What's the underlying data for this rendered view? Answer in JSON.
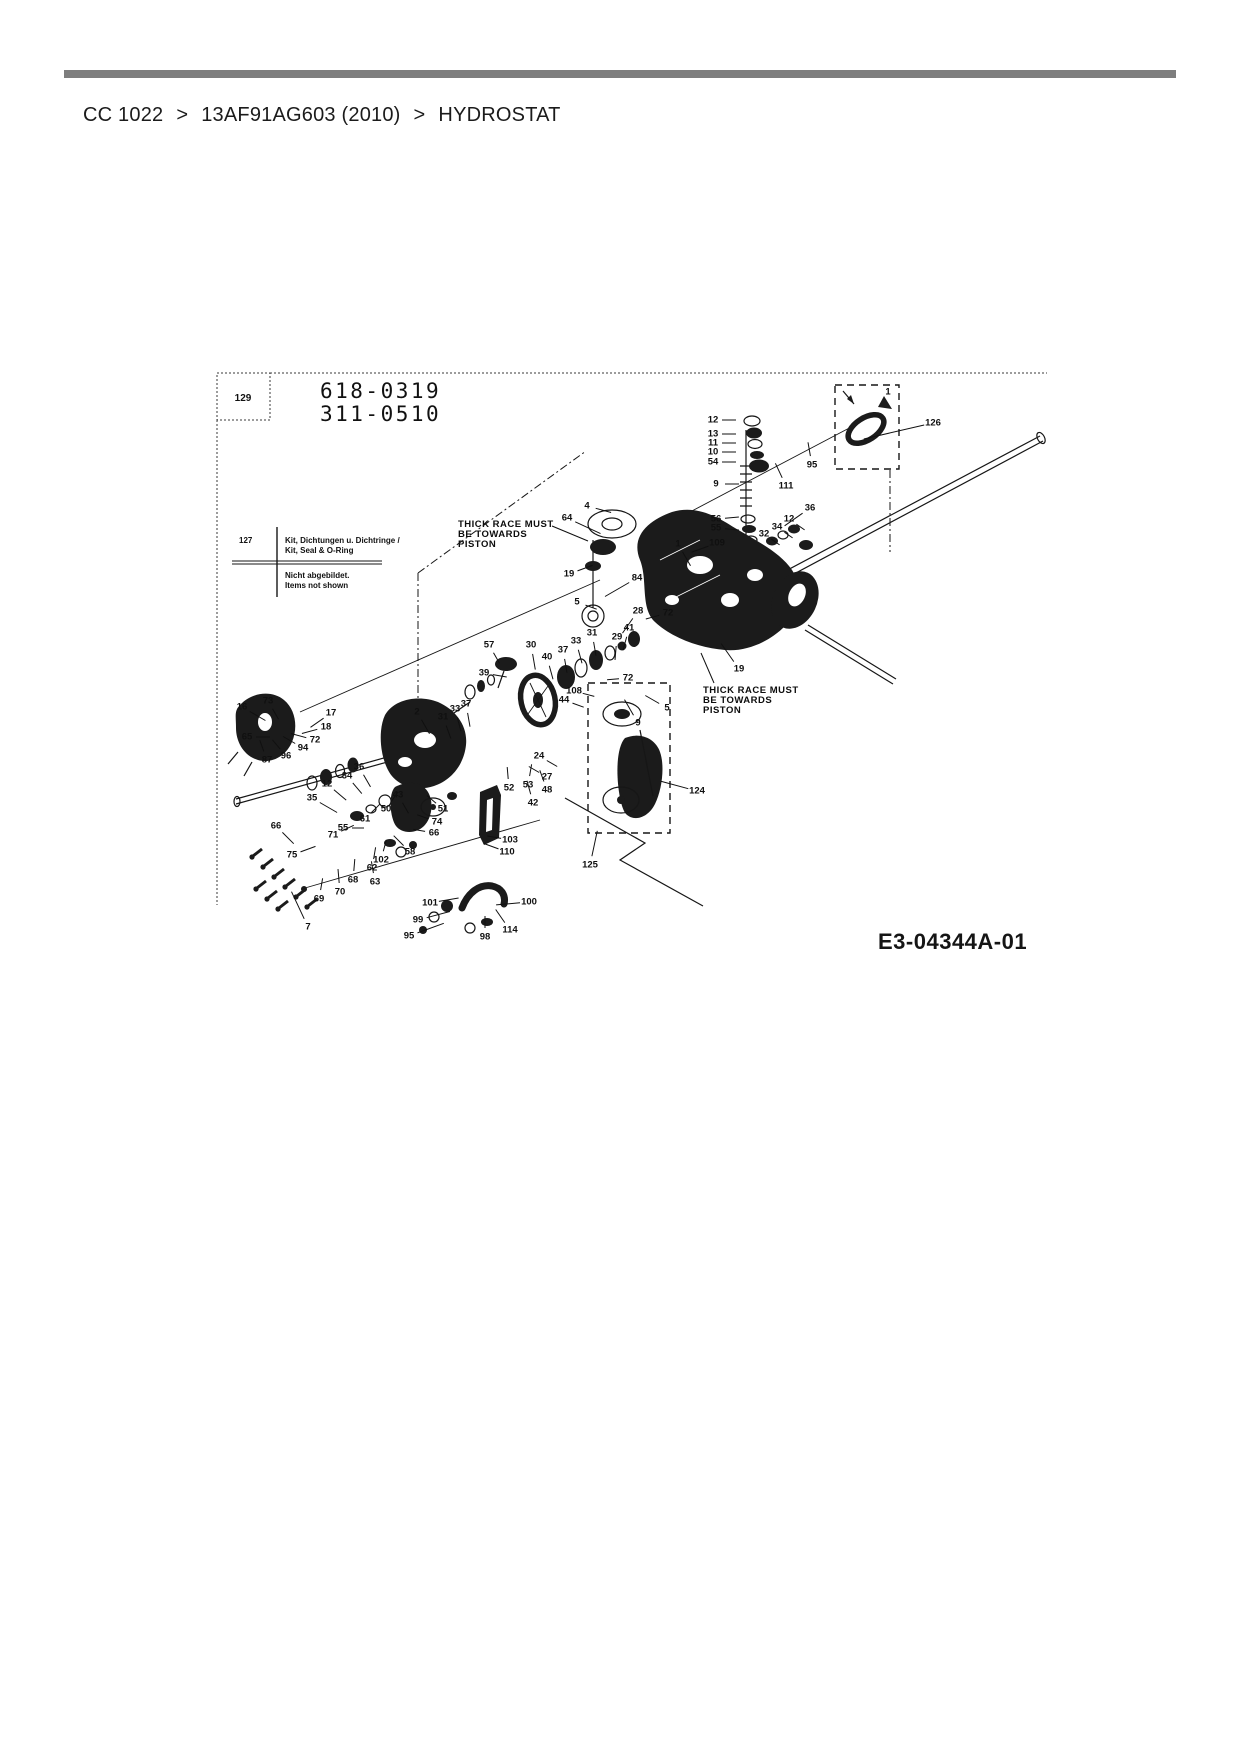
{
  "page": {
    "background": "#ffffff",
    "divider_color": "#7e7e7e"
  },
  "breadcrumb": {
    "separator": ">",
    "items": [
      "CC 1022",
      "13AF91AG603 (2010)",
      "HYDROSTAT"
    ]
  },
  "diagram": {
    "ref_box_label": "129",
    "part_numbers": [
      "618-0319",
      "311-0510"
    ],
    "kit_note": {
      "id": "127",
      "lines": [
        "Kit, Dichtungen u. Dichtringe /",
        "Kit, Seal & O-Ring",
        "Nicht abgebildet.",
        "Items not shown"
      ]
    },
    "annotations": [
      {
        "lines": [
          "THICK RACE MUST",
          "BE TOWARDS",
          "PISTON"
        ]
      },
      {
        "lines": [
          "THICK RACE MUST",
          "BE TOWARDS",
          "PISTON"
        ]
      }
    ],
    "drawing_code": "E3-04344A-01",
    "labels": [
      [
        "12",
        713,
        420,
        0,
        14
      ],
      [
        "13",
        713,
        434,
        0,
        14
      ],
      [
        "11",
        713,
        443,
        0,
        14
      ],
      [
        "10",
        713,
        452,
        0,
        14
      ],
      [
        "54",
        713,
        462,
        0,
        14
      ],
      [
        "9",
        716,
        484,
        0,
        14
      ],
      [
        "56",
        716,
        519,
        5,
        14
      ],
      [
        "55",
        716,
        528,
        355,
        14
      ],
      [
        "95",
        812,
        465,
        100,
        14
      ],
      [
        "111",
        786,
        486,
        115,
        16
      ],
      [
        "126",
        933,
        423,
        193,
        62
      ],
      [
        "1",
        888,
        392,
        0,
        0
      ],
      [
        "36",
        810,
        508,
        215,
        22
      ],
      [
        "12",
        789,
        519,
        325,
        10
      ],
      [
        "34",
        777,
        527,
        325,
        10
      ],
      [
        "32",
        764,
        534,
        325,
        10
      ],
      [
        "109",
        717,
        543,
        200,
        18
      ],
      [
        "1",
        678,
        544,
        300,
        16
      ],
      [
        "64",
        567,
        518,
        335,
        28
      ],
      [
        "4",
        587,
        506,
        345,
        16
      ],
      [
        "19",
        569,
        574,
        20,
        16
      ],
      [
        "5",
        577,
        602,
        340,
        12
      ],
      [
        "84",
        637,
        578,
        210,
        28
      ],
      [
        "28",
        638,
        611,
        235,
        18
      ],
      [
        "72",
        668,
        613,
        195,
        14
      ],
      [
        "57",
        489,
        645,
        300,
        12
      ],
      [
        "39",
        484,
        673,
        350,
        14
      ],
      [
        "30",
        531,
        645,
        280,
        16
      ],
      [
        "40",
        547,
        657,
        285,
        14
      ],
      [
        "37",
        563,
        650,
        280,
        14
      ],
      [
        "33",
        576,
        641,
        285,
        14
      ],
      [
        "31",
        592,
        633,
        280,
        14
      ],
      [
        "29",
        617,
        637,
        265,
        14
      ],
      [
        "41",
        629,
        628,
        255,
        14
      ],
      [
        "72",
        628,
        678,
        185,
        12
      ],
      [
        "108",
        574,
        691,
        345,
        12
      ],
      [
        "44",
        564,
        700,
        340,
        12
      ],
      [
        "5",
        667,
        708,
        150,
        16
      ],
      [
        "9",
        638,
        723,
        120,
        18
      ],
      [
        "19",
        739,
        669,
        125,
        22
      ],
      [
        "24",
        539,
        756,
        330,
        12
      ],
      [
        "27",
        547,
        777,
        150,
        12
      ],
      [
        "52",
        509,
        788,
        95,
        12
      ],
      [
        "53",
        528,
        785,
        80,
        12
      ],
      [
        "48",
        547,
        790,
        110,
        12
      ],
      [
        "42",
        533,
        803,
        105,
        14
      ],
      [
        "124",
        697,
        791,
        165,
        28
      ],
      [
        "125",
        590,
        865,
        78,
        26
      ],
      [
        "103",
        510,
        840,
        170,
        14
      ],
      [
        "110",
        507,
        852,
        160,
        16
      ],
      [
        "16",
        242,
        707,
        330,
        18
      ],
      [
        "73",
        268,
        701,
        300,
        12
      ],
      [
        "17",
        331,
        713,
        215,
        16
      ],
      [
        "18",
        326,
        727,
        195,
        16
      ],
      [
        "72",
        315,
        740,
        165,
        16
      ],
      [
        "94",
        303,
        748,
        150,
        14
      ],
      [
        "96",
        286,
        756,
        130,
        12
      ],
      [
        "87",
        267,
        760,
        110,
        12
      ],
      [
        "65",
        247,
        737,
        0,
        14
      ],
      [
        "2",
        417,
        712,
        300,
        16
      ],
      [
        "31",
        443,
        717,
        290,
        14
      ],
      [
        "33",
        455,
        709,
        285,
        14
      ],
      [
        "37",
        466,
        704,
        280,
        14
      ],
      [
        "36",
        359,
        767,
        300,
        14
      ],
      [
        "34",
        347,
        776,
        310,
        14
      ],
      [
        "12",
        327,
        784,
        320,
        16
      ],
      [
        "35",
        312,
        798,
        330,
        20
      ],
      [
        "66",
        276,
        826,
        315,
        16
      ],
      [
        "71",
        333,
        835,
        25,
        14
      ],
      [
        "75",
        292,
        855,
        20,
        16
      ],
      [
        "55",
        343,
        828,
        0,
        12
      ],
      [
        "61",
        365,
        819,
        45,
        12
      ],
      [
        "50",
        386,
        809,
        55,
        12
      ],
      [
        "43",
        398,
        795,
        300,
        12
      ],
      [
        "51",
        443,
        809,
        140,
        12
      ],
      [
        "74",
        437,
        822,
        160,
        12
      ],
      [
        "66",
        434,
        833,
        170,
        12
      ],
      [
        "58",
        410,
        852,
        135,
        14
      ],
      [
        "102",
        381,
        860,
        75,
        12
      ],
      [
        "62",
        372,
        868,
        80,
        12
      ],
      [
        "63",
        375,
        882,
        100,
        12
      ],
      [
        "68",
        353,
        880,
        85,
        12
      ],
      [
        "70",
        340,
        892,
        95,
        14
      ],
      [
        "69",
        319,
        899,
        80,
        12
      ],
      [
        "7",
        308,
        927,
        115,
        30
      ],
      [
        "101",
        430,
        903,
        10,
        20
      ],
      [
        "99",
        418,
        920,
        15,
        24
      ],
      [
        "95",
        409,
        936,
        20,
        28
      ],
      [
        "98",
        485,
        937,
        90,
        12
      ],
      [
        "114",
        510,
        930,
        125,
        16
      ],
      [
        "100",
        529,
        902,
        185,
        24
      ]
    ]
  }
}
